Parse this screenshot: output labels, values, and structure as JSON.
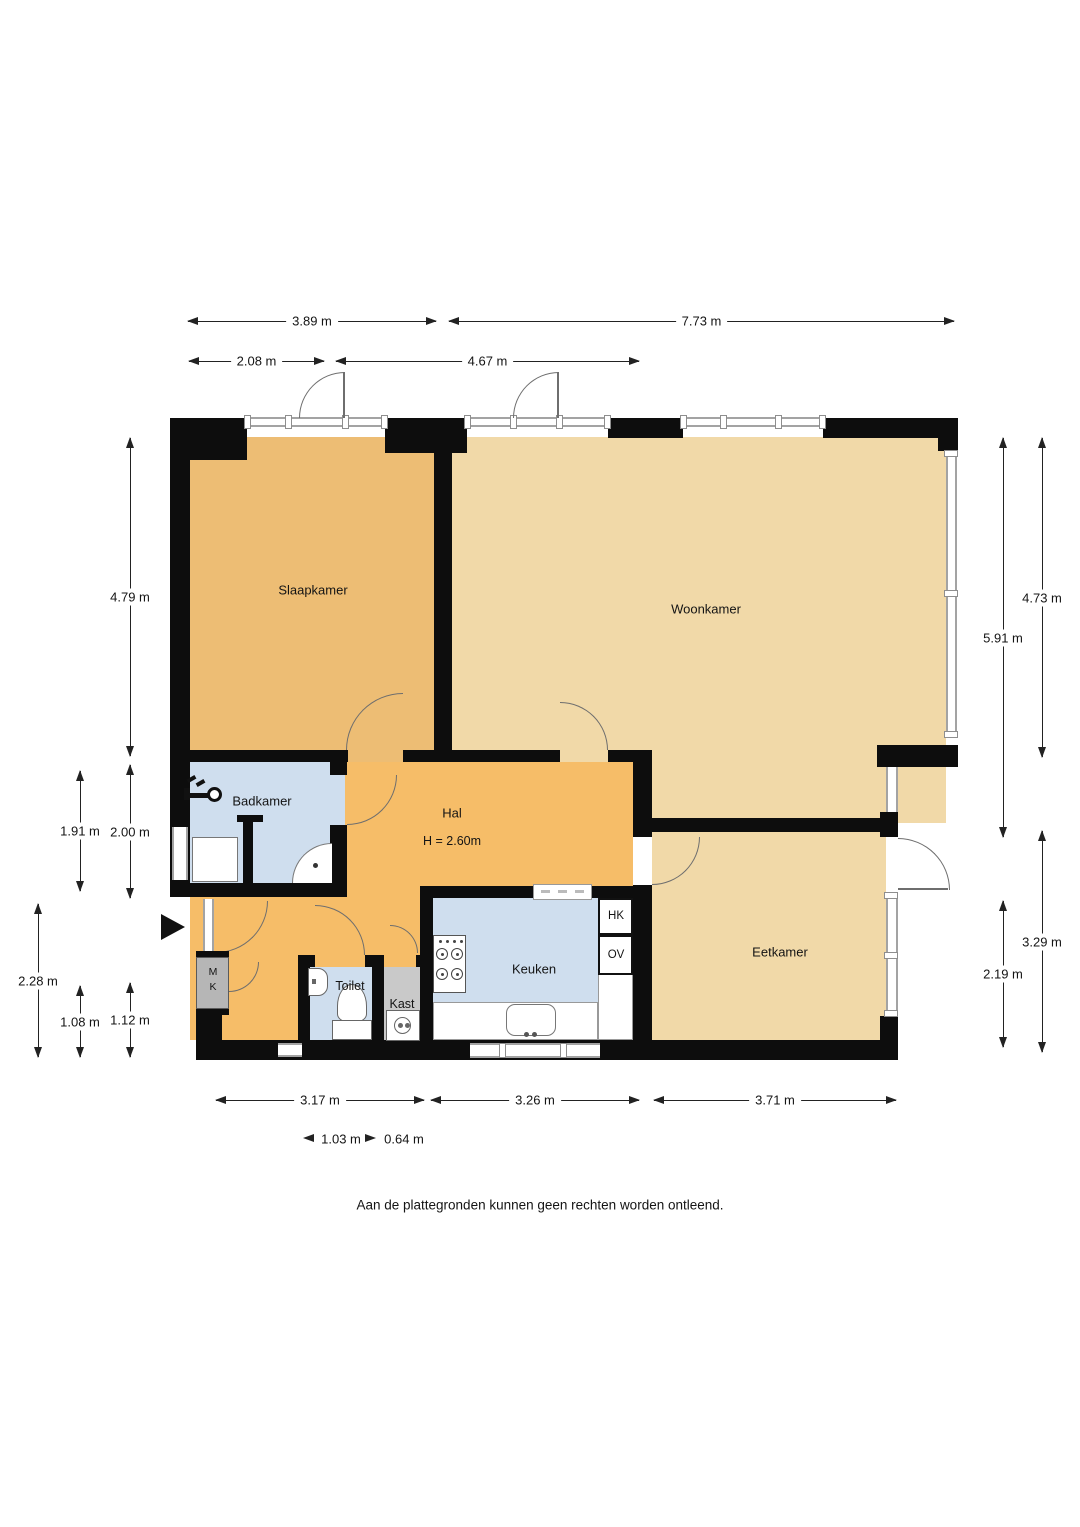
{
  "rooms": {
    "slaapkamer": "Slaapkamer",
    "woonkamer": "Woonkamer",
    "badkamer": "Badkamer",
    "hal": "Hal",
    "hal_height": "H = 2.60m",
    "keuken": "Keuken",
    "eetkamer": "Eetkamer",
    "toilet": "Toilet",
    "kast": "Kast",
    "cupboard_hk": "HK",
    "cupboard_ov": "OV",
    "meter_m": "M",
    "meter_k": "K"
  },
  "dims": {
    "t1a": "3.89 m",
    "t1b": "7.73 m",
    "t2a": "2.08 m",
    "t2b": "4.67 m",
    "l1": "4.79 m",
    "l2": "1.91 m",
    "l3": "2.00 m",
    "l4": "2.28 m",
    "l5": "1.08 m",
    "l6": "1.12 m",
    "r1": "4.73 m",
    "r2": "5.91 m",
    "r3": "3.29 m",
    "r4": "2.19 m",
    "b1": "3.17 m",
    "b2": "3.26 m",
    "b3": "3.71 m",
    "s1": "1.03 m",
    "s2": "0.64 m"
  },
  "footer": "Aan de plattegronden kunnen geen rechten worden ontleend.",
  "colors": {
    "slaapkamer": "#edbd74",
    "hal": "#f6bd68",
    "tan_rooms": "#f1d9a8",
    "wet_rooms": "#cfdeee",
    "kast": "#c9c9c9",
    "wall": "#0d0d0d"
  }
}
